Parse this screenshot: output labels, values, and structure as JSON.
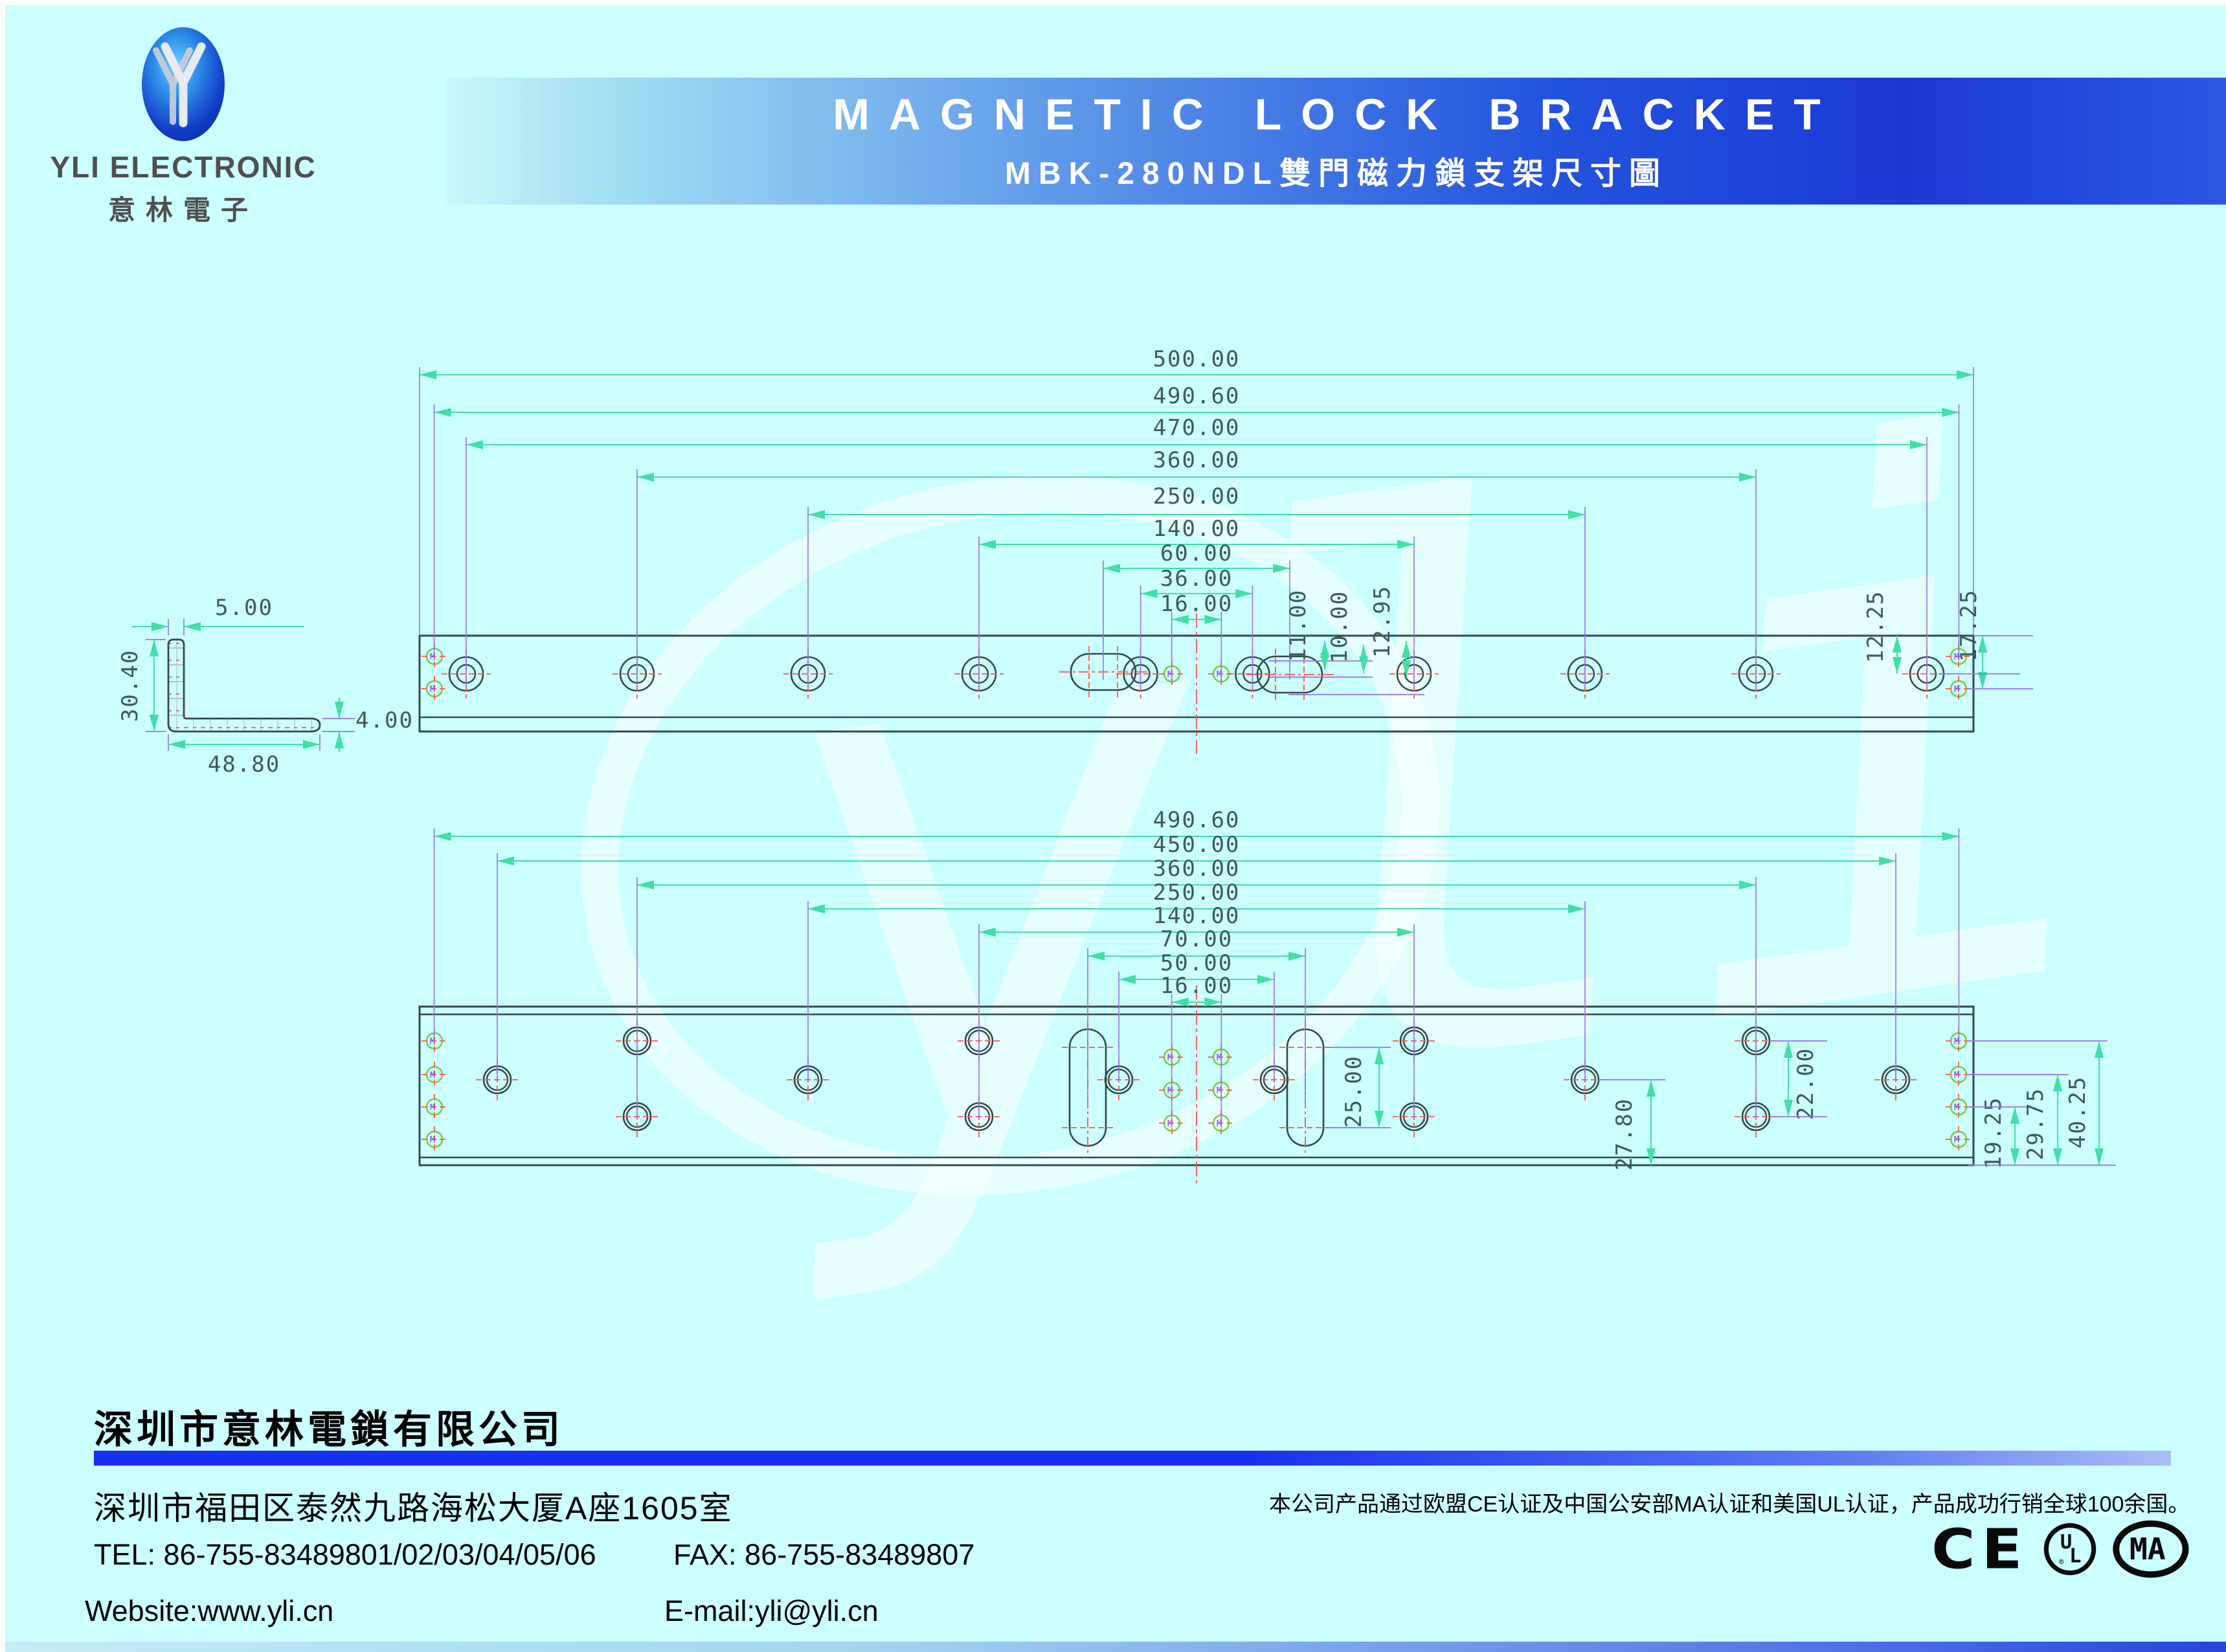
{
  "header": {
    "brand": "YLI ELECTRONIC",
    "brand_cn": "意林電子",
    "title": "MAGNETIC LOCK BRACKET",
    "subtitle": "MBK-280NDL雙門磁力鎖支架尺寸圖"
  },
  "colors": {
    "page_bg": "#ccffff",
    "banner_blue": "#1a3ad5",
    "dimension_line": "#3fe0a4",
    "extension_line": "#9b6ff0",
    "centerline_red": "#ff5544",
    "outline": "#35494a",
    "hole_green": "#7acc3a",
    "footer_bar_blue": "#1730ee"
  },
  "upper_drawing": {
    "h_dims": [
      {
        "label": "500.00",
        "mm": 500.0
      },
      {
        "label": "490.60",
        "mm": 490.6
      },
      {
        "label": "470.00",
        "mm": 470.0
      },
      {
        "label": "360.00",
        "mm": 360.0
      },
      {
        "label": "250.00",
        "mm": 250.0
      },
      {
        "label": "140.00",
        "mm": 140.0
      },
      {
        "label": "60.00",
        "mm": 60.0
      },
      {
        "label": "36.00",
        "mm": 36.0
      },
      {
        "label": "16.00",
        "mm": 16.0
      }
    ],
    "v_dims": [
      {
        "label": "11.00"
      },
      {
        "label": "10.00"
      },
      {
        "label": "12.95"
      },
      {
        "label": "12.25"
      },
      {
        "label": "17.25"
      }
    ],
    "section_dims": [
      {
        "label": "5.00"
      },
      {
        "label": "30.40"
      },
      {
        "label": "48.80"
      },
      {
        "label": "4.00"
      }
    ]
  },
  "lower_drawing": {
    "h_dims": [
      {
        "label": "490.60",
        "mm": 490.6
      },
      {
        "label": "450.00",
        "mm": 450.0
      },
      {
        "label": "360.00",
        "mm": 360.0
      },
      {
        "label": "250.00",
        "mm": 250.0
      },
      {
        "label": "140.00",
        "mm": 140.0
      },
      {
        "label": "70.00",
        "mm": 70.0
      },
      {
        "label": "50.00",
        "mm": 50.0
      },
      {
        "label": "16.00",
        "mm": 16.0
      }
    ],
    "v_dims": [
      {
        "label": "25.00"
      },
      {
        "label": "27.80"
      },
      {
        "label": "22.00"
      },
      {
        "label": "19.25"
      },
      {
        "label": "29.75"
      },
      {
        "label": "40.25"
      }
    ]
  },
  "watermark": "yli",
  "footer": {
    "company": "深圳市意林電鎖有限公司",
    "address": "深圳市福田区泰然九路海松大厦A座1605室",
    "cert_note": "本公司产品通过欧盟CE认证及中国公安部MA认证和美国UL认证，产品成功行销全球100余国。",
    "tel": "TEL: 86-755-83489801/02/03/04/05/06",
    "fax": "FAX: 86-755-83489807",
    "website": "Website:www.yli.cn",
    "email": "E-mail:yli@yli.cn",
    "certs": {
      "ce": "CE",
      "ul": "UL",
      "ma": "MA"
    }
  }
}
